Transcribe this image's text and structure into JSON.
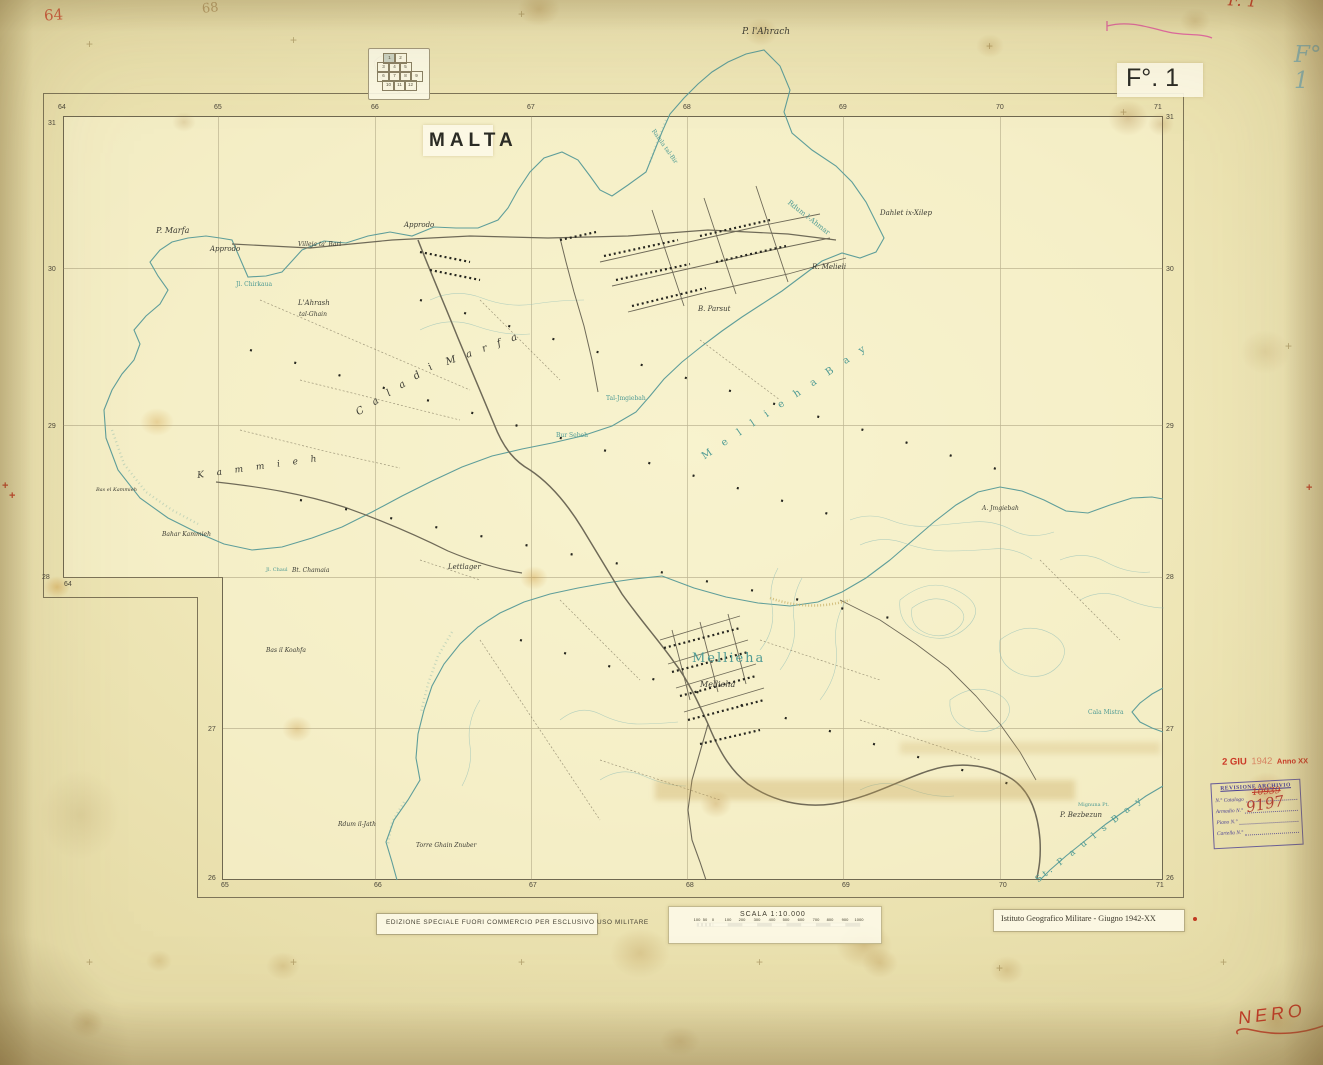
{
  "sheet": {
    "title": "MALTA",
    "sheet_number": "F°. 1",
    "edition_note": "EDIZIONE SPECIALE FUORI COMMERCIO PER ESCLUSIVO USO MILITARE",
    "credit": "Istituto Geografico Militare - Giugno 1942-XX",
    "scale_label": "SCALA 1:10.000"
  },
  "annotations": {
    "pencil_64": "64",
    "pencil_68": "68",
    "red_f1": "F. 1",
    "blue_f1": "F° 1",
    "nero": "NERO"
  },
  "date_stamp": {
    "d1": "2 GIU",
    "d2": "1942",
    "d3": "Anno XX"
  },
  "archive_stamp": {
    "header": "REVISIONE ARCHIVIO",
    "rows": [
      "N.° Catalogo",
      "Armadio  N.°",
      "Piano  N.°",
      "Cartella  N.°"
    ],
    "catalog_value": "10939",
    "armadio_value": "9197"
  },
  "index_diagram": {
    "highlighted": "1",
    "cells": [
      {
        "t": "1",
        "x": 14,
        "y": 4
      },
      {
        "t": "2",
        "x": 25,
        "y": 4
      },
      {
        "t": "3",
        "x": 8,
        "y": 13
      },
      {
        "t": "4",
        "x": 19,
        "y": 13
      },
      {
        "t": "5",
        "x": 30,
        "y": 13
      },
      {
        "t": "6",
        "x": 8,
        "y": 22
      },
      {
        "t": "7",
        "x": 19,
        "y": 22
      },
      {
        "t": "8",
        "x": 30,
        "y": 22
      },
      {
        "t": "9",
        "x": 41,
        "y": 22
      },
      {
        "t": "10",
        "x": 13,
        "y": 31
      },
      {
        "t": "11",
        "x": 24,
        "y": 31
      },
      {
        "t": "12",
        "x": 35,
        "y": 31
      }
    ]
  },
  "grid_numbers": [
    {
      "t": "64",
      "x": 58,
      "y": 104
    },
    {
      "t": "65",
      "x": 214,
      "y": 104
    },
    {
      "t": "66",
      "x": 371,
      "y": 104
    },
    {
      "t": "67",
      "x": 527,
      "y": 104
    },
    {
      "t": "68",
      "x": 683,
      "y": 104
    },
    {
      "t": "69",
      "x": 839,
      "y": 104
    },
    {
      "t": "70",
      "x": 996,
      "y": 104
    },
    {
      "t": "71",
      "x": 1154,
      "y": 104
    },
    {
      "t": "65",
      "x": 221,
      "y": 882
    },
    {
      "t": "66",
      "x": 374,
      "y": 882
    },
    {
      "t": "67",
      "x": 529,
      "y": 882
    },
    {
      "t": "68",
      "x": 686,
      "y": 882
    },
    {
      "t": "69",
      "x": 842,
      "y": 882
    },
    {
      "t": "70",
      "x": 999,
      "y": 882
    },
    {
      "t": "71",
      "x": 1156,
      "y": 882
    },
    {
      "t": "31",
      "x": 48,
      "y": 120
    },
    {
      "t": "30",
      "x": 48,
      "y": 266
    },
    {
      "t": "29",
      "x": 48,
      "y": 423
    },
    {
      "t": "28",
      "x": 42,
      "y": 574
    },
    {
      "t": "64",
      "x": 64,
      "y": 581
    },
    {
      "t": "27",
      "x": 208,
      "y": 726
    },
    {
      "t": "26",
      "x": 208,
      "y": 875
    },
    {
      "t": "31",
      "x": 1166,
      "y": 114
    },
    {
      "t": "30",
      "x": 1166,
      "y": 266
    },
    {
      "t": "29",
      "x": 1166,
      "y": 423
    },
    {
      "t": "28",
      "x": 1166,
      "y": 574
    },
    {
      "t": "27",
      "x": 1166,
      "y": 726
    },
    {
      "t": "26",
      "x": 1166,
      "y": 875
    }
  ],
  "scale_bar": {
    "ticks": [
      {
        "t": "100",
        "x": 697
      },
      {
        "t": "50",
        "x": 705
      },
      {
        "t": "0",
        "x": 713
      },
      {
        "t": "100",
        "x": 728
      },
      {
        "t": "200",
        "x": 742
      },
      {
        "t": "300",
        "x": 757
      },
      {
        "t": "400",
        "x": 772
      },
      {
        "t": "500",
        "x": 786
      },
      {
        "t": "600",
        "x": 801
      },
      {
        "t": "700",
        "x": 816
      },
      {
        "t": "800",
        "x": 830
      },
      {
        "t": "900",
        "x": 845
      },
      {
        "t": "1000",
        "x": 859
      }
    ]
  },
  "map_labels": [
    {
      "t": "P. l'Ahrach",
      "x": 742,
      "y": 28,
      "s": 9
    },
    {
      "t": "Rdum l-Ahmar",
      "x": 786,
      "y": 198,
      "s": 7,
      "a": 38,
      "c": "t"
    },
    {
      "t": "Ramla tal-Bir",
      "x": 650,
      "y": 126,
      "s": 6,
      "a": 55,
      "c": "t"
    },
    {
      "t": "Dahlet ix-Xilep",
      "x": 880,
      "y": 210,
      "s": 7
    },
    {
      "t": "R. Melieli",
      "x": 812,
      "y": 264,
      "s": 7
    },
    {
      "t": "B. Parsut",
      "x": 698,
      "y": 306,
      "s": 7
    },
    {
      "t": "P. Marfa",
      "x": 156,
      "y": 227,
      "s": 8
    },
    {
      "t": "Approdo",
      "x": 210,
      "y": 246,
      "s": 7
    },
    {
      "t": "Villeja ta' Bari",
      "x": 298,
      "y": 242,
      "s": 6
    },
    {
      "t": "Approdo",
      "x": 404,
      "y": 222,
      "s": 7
    },
    {
      "t": "Jl. Chirkaua",
      "x": 236,
      "y": 282,
      "s": 6,
      "c": "t"
    },
    {
      "t": "L'Ahrash",
      "x": 298,
      "y": 300,
      "s": 7
    },
    {
      "t": "tal-Ghain",
      "x": 299,
      "y": 312,
      "s": 6
    },
    {
      "t": "C a l a   d i",
      "x": 360,
      "y": 408,
      "s": 10,
      "a": -32,
      "sp": 4
    },
    {
      "t": "M a r f a",
      "x": 448,
      "y": 358,
      "s": 10,
      "a": -20,
      "sp": 4
    },
    {
      "t": "K a m m i e h",
      "x": 198,
      "y": 472,
      "s": 9,
      "a": -8,
      "sp": 5
    },
    {
      "t": "Bas el Kammieh",
      "x": 96,
      "y": 488,
      "s": 5
    },
    {
      "t": "Bahar Kammieh",
      "x": 162,
      "y": 532,
      "s": 6
    },
    {
      "t": "M e l l i e h a   B a y",
      "x": 706,
      "y": 452,
      "s": 10,
      "a": -34,
      "sp": 5,
      "c": "t"
    },
    {
      "t": "Bur Sebeh",
      "x": 556,
      "y": 433,
      "s": 6,
      "c": "t"
    },
    {
      "t": "Tal-Jmgiebah",
      "x": 606,
      "y": 396,
      "s": 6,
      "c": "t"
    },
    {
      "t": "Lettlager",
      "x": 448,
      "y": 564,
      "s": 7
    },
    {
      "t": "Jl. Chaul",
      "x": 266,
      "y": 568,
      "s": 5,
      "c": "t"
    },
    {
      "t": "Bt. Chamaia",
      "x": 292,
      "y": 568,
      "s": 6
    },
    {
      "t": "Bas il Koahfa",
      "x": 266,
      "y": 648,
      "s": 6
    },
    {
      "t": "Mellieha",
      "x": 692,
      "y": 652,
      "s": 13,
      "sp": 2,
      "c": "t"
    },
    {
      "t": "Mellieha",
      "x": 700,
      "y": 681,
      "s": 8
    },
    {
      "t": "A. Jmgiebah",
      "x": 982,
      "y": 506,
      "s": 6
    },
    {
      "t": "Rdum il-Jath",
      "x": 338,
      "y": 822,
      "s": 6
    },
    {
      "t": "Torre Ghain Znuber",
      "x": 416,
      "y": 843,
      "s": 6
    },
    {
      "t": "P. Bezbezun",
      "x": 1060,
      "y": 812,
      "s": 7
    },
    {
      "t": "Mignuna Pt.",
      "x": 1078,
      "y": 803,
      "s": 5,
      "c": "t"
    },
    {
      "t": "Cala Mistra",
      "x": 1088,
      "y": 710,
      "s": 6,
      "c": "t"
    },
    {
      "t": "St. P a u l s   B a y",
      "x": 1040,
      "y": 876,
      "s": 9,
      "a": -38,
      "sp": 3,
      "c": "t"
    }
  ]
}
